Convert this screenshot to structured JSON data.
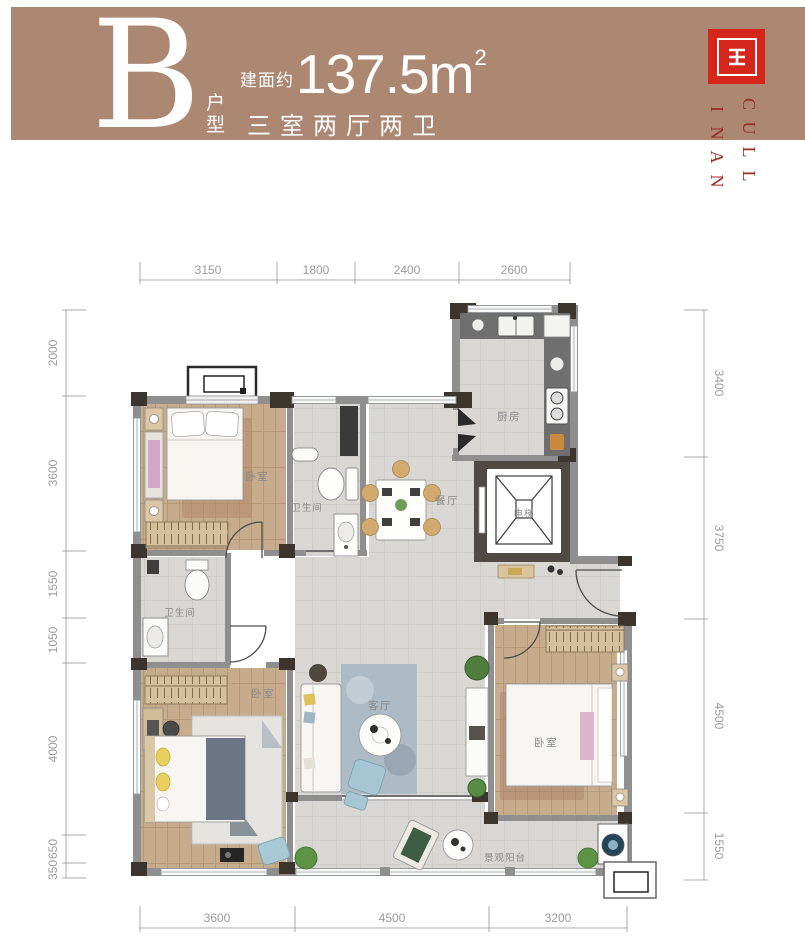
{
  "header": {
    "unit_letter": "B",
    "unit_type": "户型",
    "area_prefix": "建面约",
    "area_number": "137.5m",
    "area_exponent": "2",
    "layout_summary": "三室两厅两卫"
  },
  "logo": {
    "brand_col_right": "CULL",
    "brand_col_left": "INAN"
  },
  "colors": {
    "header_band": "#ac8772",
    "logo_red": "#d6261c",
    "brand_text": "#9e2d26",
    "wall_gray": "#8f8f8f",
    "pier_dark": "#3b352d",
    "wood_floor": "#c6ac8c",
    "tile_floor": "#d8d7d3",
    "rug_blue": "#adbbc7"
  },
  "floorplan": {
    "rooms": {
      "bedroom1": "卧室",
      "bath1": "卫生间",
      "dining": "餐厅",
      "kitchen": "厨房",
      "elevator": "电梯",
      "bath2": "卫生间",
      "bedroom2": "卧室",
      "living": "客厅",
      "master": "卧室",
      "balcony": "景观阳台"
    },
    "dimensions": {
      "top": [
        "3150",
        "1800",
        "2400",
        "2600"
      ],
      "left": [
        "2000",
        "3600",
        "1550",
        "1050",
        "4000",
        "650",
        "350"
      ],
      "right": [
        "3400",
        "3750",
        "4500",
        "1550"
      ],
      "bottom": [
        "3600",
        "4500",
        "3200"
      ]
    }
  }
}
